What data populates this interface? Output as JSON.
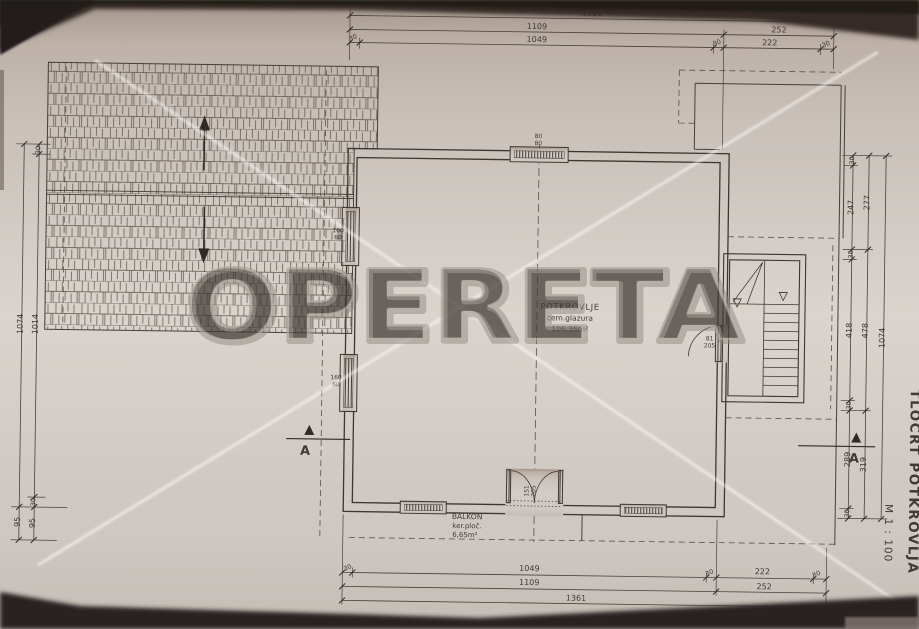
{
  "photo": {
    "watermark_text": "OPERETA"
  },
  "titleblock": {
    "drawing_title": "TLOCRT POTKROVLJA",
    "scale_label": "M 1 : 100"
  },
  "room": {
    "name": "POTKROVLJE",
    "finish": "cem.glazura",
    "area": "106,36m²"
  },
  "balcony": {
    "name": "BALKON",
    "finish": "ker.ploč.",
    "area": "6,65m²"
  },
  "section_marker": {
    "label": "A"
  },
  "openings": {
    "roof_window": {
      "w": "80",
      "h": "80"
    },
    "side_window": {
      "w": "160",
      "h": "60"
    },
    "balcony_door": {
      "w": "151",
      "h": "205"
    },
    "stair_door": {
      "w": "81",
      "h": "205"
    }
  },
  "dims": {
    "d1361": "1361",
    "d1109": "1109",
    "d252": "252",
    "d1049": "1049",
    "d222": "222",
    "d30": "30",
    "d1074": "1074",
    "d1014": "1014",
    "d95": "95",
    "d247": "247",
    "d277": "277",
    "d418": "418",
    "d478": "478",
    "d289": "289",
    "d319": "319"
  }
}
